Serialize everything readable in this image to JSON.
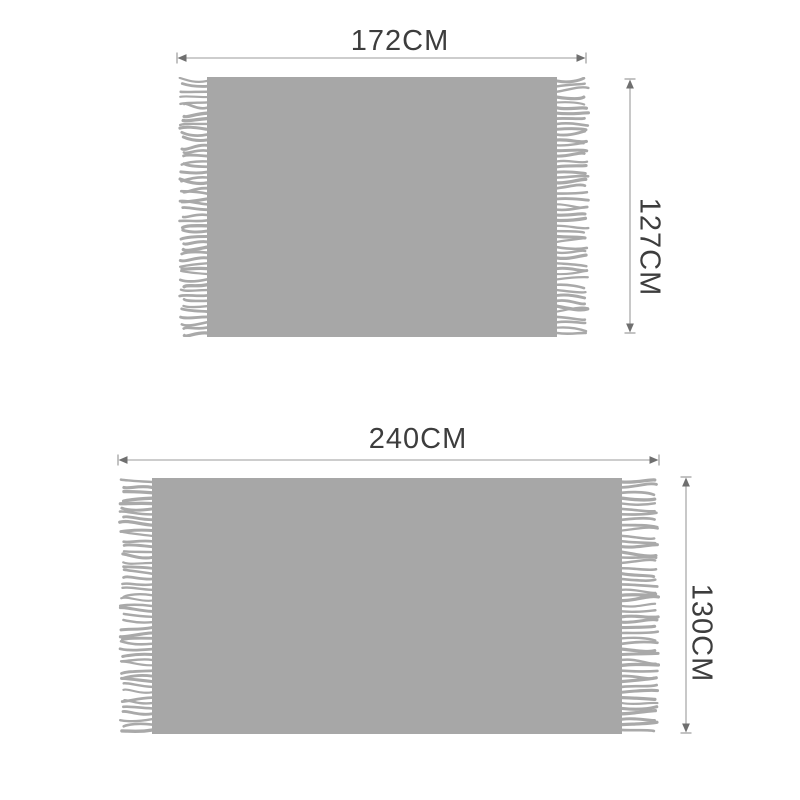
{
  "figures": [
    {
      "id": "small-blanket",
      "width_label": "172CM",
      "height_label": "127CM",
      "width_cm": 172,
      "height_cm": 127
    },
    {
      "id": "large-blanket",
      "width_label": "240CM",
      "height_label": "130CM",
      "width_cm": 240,
      "height_cm": 130
    }
  ],
  "colors": {
    "background": "#ffffff",
    "blanket": "#a7a7a7",
    "fringe": "#a9a9a9",
    "dimension_line": "#9b9b9b",
    "arrowhead": "#6f6f6f",
    "label_text": "#3d3d3d"
  }
}
